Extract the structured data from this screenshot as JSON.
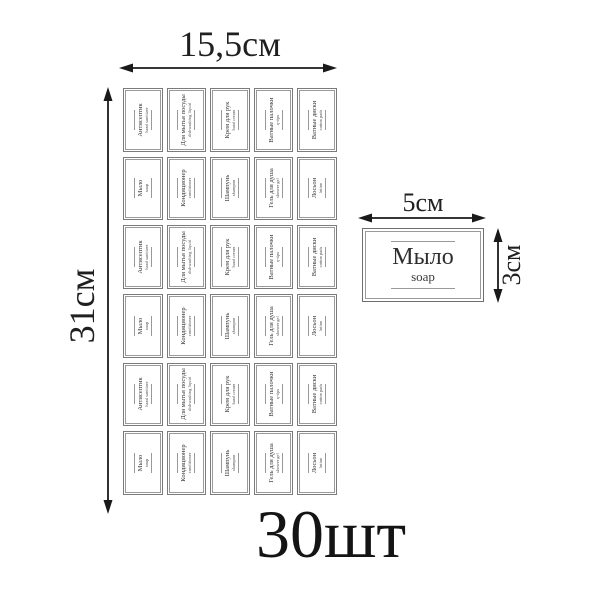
{
  "sheet": {
    "width_label": "15,5см",
    "height_label": "31см",
    "rows": 6,
    "cols": 5,
    "cells": [
      {
        "main": "Антисептик",
        "sub": "hand sanitizer"
      },
      {
        "main": "Для мытья посуды",
        "sub": "dishwashing liquid"
      },
      {
        "main": "Крем для рук",
        "sub": "hand cream"
      },
      {
        "main": "Ватные палочки",
        "sub": "q-tips"
      },
      {
        "main": "Ватные диски",
        "sub": "cotton pads"
      },
      {
        "main": "Мыло",
        "sub": "soap"
      },
      {
        "main": "Кондиционер",
        "sub": "conditioner"
      },
      {
        "main": "Шампунь",
        "sub": "shampoo"
      },
      {
        "main": "Гель для душа",
        "sub": "shower gel"
      },
      {
        "main": "Лосьон",
        "sub": "lotion"
      },
      {
        "main": "Антисептик",
        "sub": "hand sanitizer"
      },
      {
        "main": "Для мытья посуды",
        "sub": "dishwashing liquid"
      },
      {
        "main": "Крем для рук",
        "sub": "hand cream"
      },
      {
        "main": "Ватные палочки",
        "sub": "q-tips"
      },
      {
        "main": "Ватные диски",
        "sub": "cotton pads"
      },
      {
        "main": "Мыло",
        "sub": "soap"
      },
      {
        "main": "Кондиционер",
        "sub": "conditioner"
      },
      {
        "main": "Шампунь",
        "sub": "shampoo"
      },
      {
        "main": "Гель для душа",
        "sub": "shower gel"
      },
      {
        "main": "Лосьон",
        "sub": "lotion"
      },
      {
        "main": "Антисептик",
        "sub": "hand sanitizer"
      },
      {
        "main": "Для мытья посуды",
        "sub": "dishwashing liquid"
      },
      {
        "main": "Крем для рук",
        "sub": "hand cream"
      },
      {
        "main": "Ватные палочки",
        "sub": "q-tips"
      },
      {
        "main": "Ватные диски",
        "sub": "cotton pads"
      },
      {
        "main": "Мыло",
        "sub": "soap"
      },
      {
        "main": "Кондиционер",
        "sub": "conditioner"
      },
      {
        "main": "Шампунь",
        "sub": "shampoo"
      },
      {
        "main": "Гель для душа",
        "sub": "shower gel"
      },
      {
        "main": "Лосьон",
        "sub": "lotion"
      }
    ]
  },
  "sample": {
    "main": "Мыло",
    "sub": "soap",
    "width_label": "5см",
    "height_label": "3см"
  },
  "count_label": "30шт",
  "colors": {
    "arrow_and_text": "#1a1a1a",
    "label_border": "#8a8a8a",
    "label_text": "#333333"
  }
}
